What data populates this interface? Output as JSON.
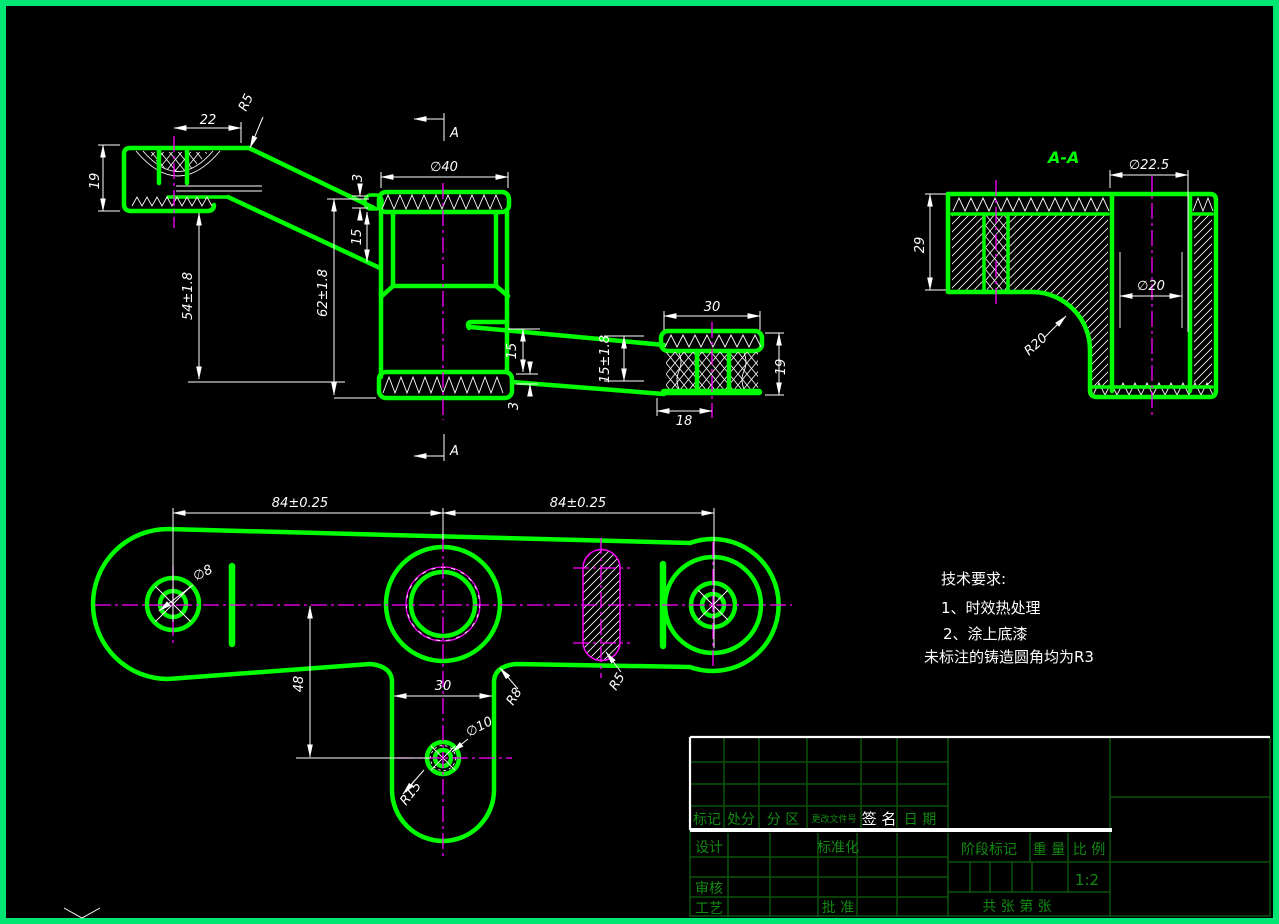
{
  "colors": {
    "background": "#000000",
    "part_line": "#00ff00",
    "sheet_border": "#00e673",
    "centerline": "#ff00ff",
    "dimension": "#ffffff",
    "table_line": "#0a520a",
    "table_text": "#128a12"
  },
  "side_view": {
    "section_label": "A",
    "dim_22": "22",
    "dim_r5": "R5",
    "dim_19": "19",
    "dim_54": "54±1.8",
    "dim_62": "62±1.8",
    "dim_3_top": "3",
    "dim_15_left": "15",
    "dim_d40": "∅40",
    "dim_15_mid": "15",
    "dim_15_tol": "15±1.8",
    "dim_3_bottom": "3",
    "dim_30": "30",
    "dim_19_right": "19",
    "dim_18": "18"
  },
  "section_view": {
    "title": "A-A",
    "dim_29": "29",
    "dim_d225": "∅22.5",
    "dim_d20": "∅20",
    "dim_r20": "R20"
  },
  "plan_view": {
    "dim_84_left": "84±0.25",
    "dim_84_right": "84±0.25",
    "dim_d8": "∅8",
    "dim_48": "48",
    "dim_30": "30",
    "dim_d10": "∅10",
    "dim_r15": "R15",
    "dim_r8": "R8",
    "dim_r5": "R5"
  },
  "tech_requirements": {
    "title": "技术要求:",
    "item_1": "1、时效热处理",
    "item_2": "2、涂上底漆",
    "note": "未标注的铸造圆角均为R3"
  },
  "title_block": {
    "mark": "标记",
    "count": "处分",
    "zone": "分 区",
    "change_file_no": "更改文件号",
    "signature": "签 名",
    "date": "日 期",
    "design": "设计",
    "standardization": "标准化",
    "audit": "审核",
    "process": "工艺",
    "approve": "批 准",
    "stage_mark": "阶段标记",
    "weight": "重 量",
    "scale_label": "比 例",
    "scale_value": "1:2",
    "sheet_info": "共  张 第  张"
  }
}
